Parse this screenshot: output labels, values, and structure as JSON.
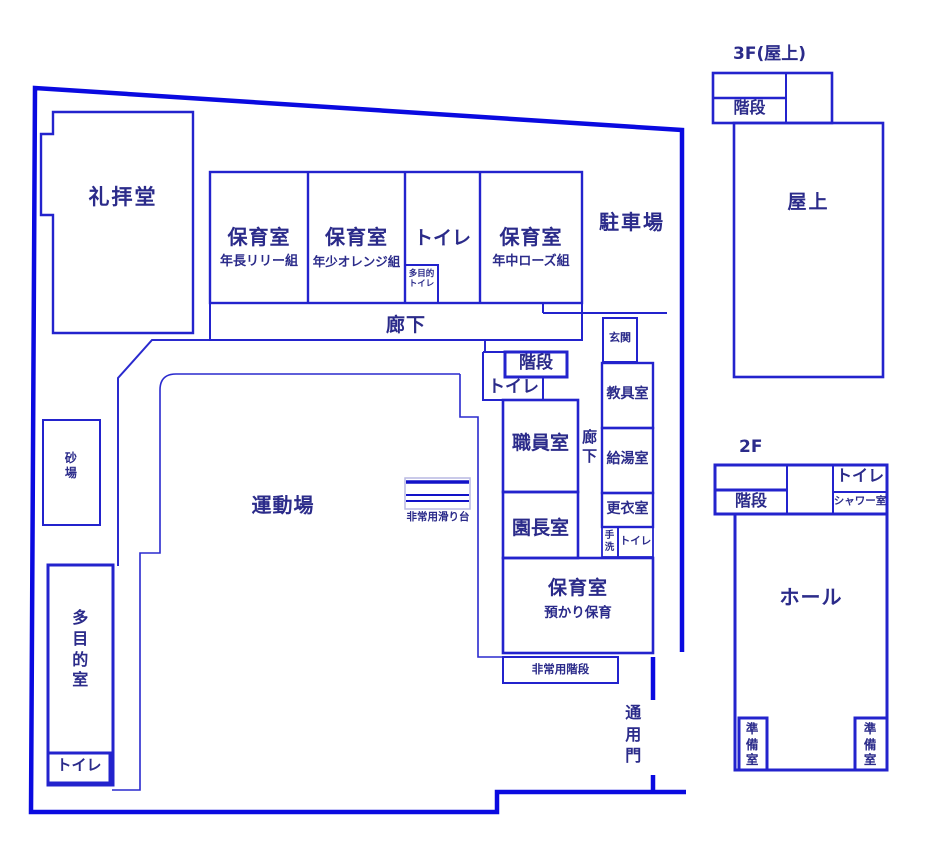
{
  "colors": {
    "boundary": "#0a0ae0",
    "wall": "#2323cd",
    "text": "#2b2b8a",
    "slide_frame": "#b9b9e2"
  },
  "f1": {
    "chapel": "礼拝堂",
    "room1_title": "保育室",
    "room1_sub": "年長リリー組",
    "room2_title": "保育室",
    "room2_sub": "年少オレンジ組",
    "toilet_row": "トイレ",
    "mp_toilet_l1": "多目的",
    "mp_toilet_l2": "トイレ",
    "room3_title": "保育室",
    "room3_sub": "年中ローズ組",
    "parking": "駐車場",
    "corridor": "廊下",
    "entrance": "玄関",
    "stairs": "階段",
    "toilet_mid": "トイレ",
    "staff_room": "職員室",
    "corridor_v": "廊下",
    "teaching_room": "教具室",
    "kitchen": "給湯室",
    "changing_room": "更衣室",
    "principal_room": "園長室",
    "handwash": "手洗",
    "toilet_small": "トイレ",
    "room4_title": "保育室",
    "room4_sub": "預かり保育",
    "emergency_stairs": "非常用階段",
    "service_gate": "通用門",
    "playground": "運動場",
    "sandbox": "砂場",
    "multipurpose_room": "多目的室",
    "toilet_bottom": "トイレ",
    "emergency_slide": "非常用滑り台"
  },
  "f2": {
    "label": "2F",
    "stairs": "階段",
    "toilet": "トイレ",
    "shower": "シャワー室",
    "hall": "ホール",
    "prep_left": "準備室",
    "prep_right": "準備室"
  },
  "f3": {
    "label": "3F(屋上)",
    "stairs": "階段",
    "rooftop": "屋上"
  }
}
